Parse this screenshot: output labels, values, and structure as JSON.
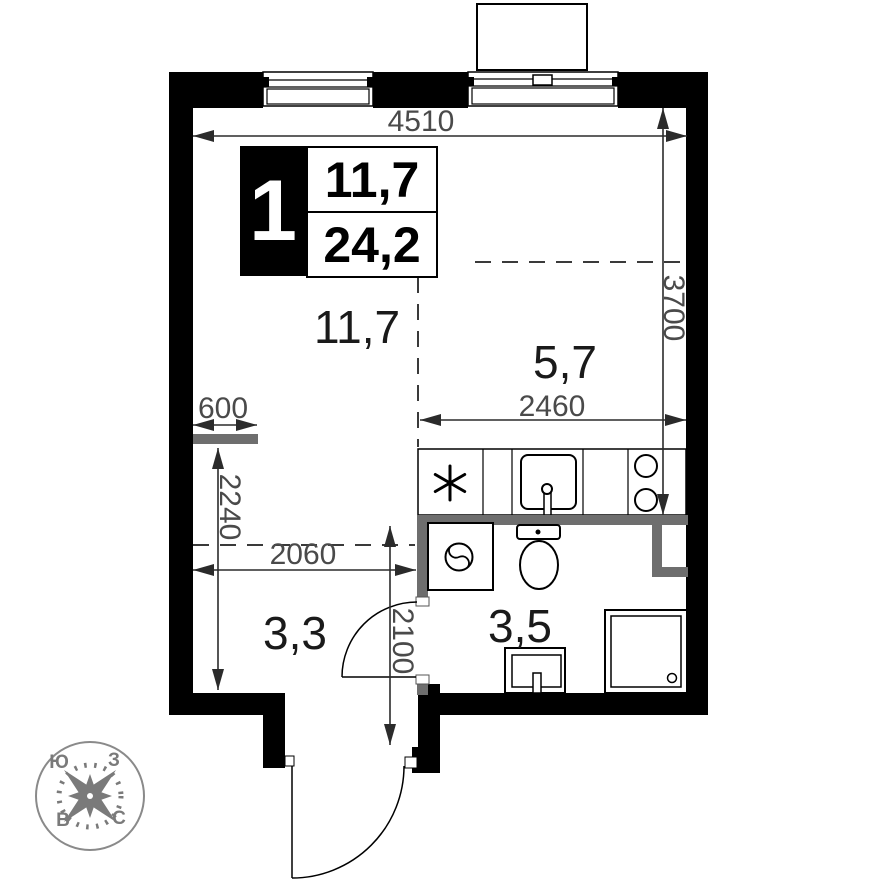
{
  "legend": {
    "apartment_number": "1",
    "living_area": "11,7",
    "total_area": "24,2"
  },
  "rooms": {
    "living": "11,7",
    "kitchen": "5,7",
    "hallway": "3,3",
    "bathroom": "3,5"
  },
  "dimensions": {
    "top_width": "4510",
    "right_height": "3700",
    "kitchen_width": "2460",
    "niche_width": "600",
    "hall_height": "2240",
    "hall_width": "2060",
    "entry_zone_height": "2100"
  },
  "compass": {
    "south": "Ю",
    "west": "З",
    "east": "В",
    "north": "С"
  },
  "colors": {
    "wall": "#000000",
    "partition": "#6e6e6e",
    "dimension_text": "#4a4a4a",
    "room_text": "#1a1a1a",
    "compass": "#7a7a7a"
  }
}
